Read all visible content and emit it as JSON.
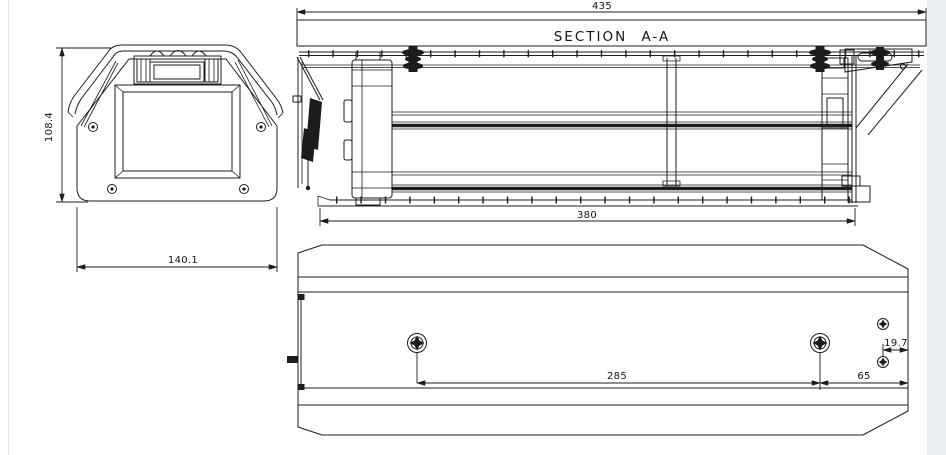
{
  "drawing": {
    "section_title": "SECTION A-A",
    "dims": {
      "front_height": "108.4",
      "front_width": "140.1",
      "section_overall": "435",
      "section_inner": "380",
      "bottom_hole_spacing": "285",
      "bottom_edge_offset": "65",
      "bottom_side_offset": "19.7"
    },
    "colors": {
      "line": "#1c1c1c",
      "background": "#ffffff",
      "edge_strip": "#eaedf1"
    }
  }
}
